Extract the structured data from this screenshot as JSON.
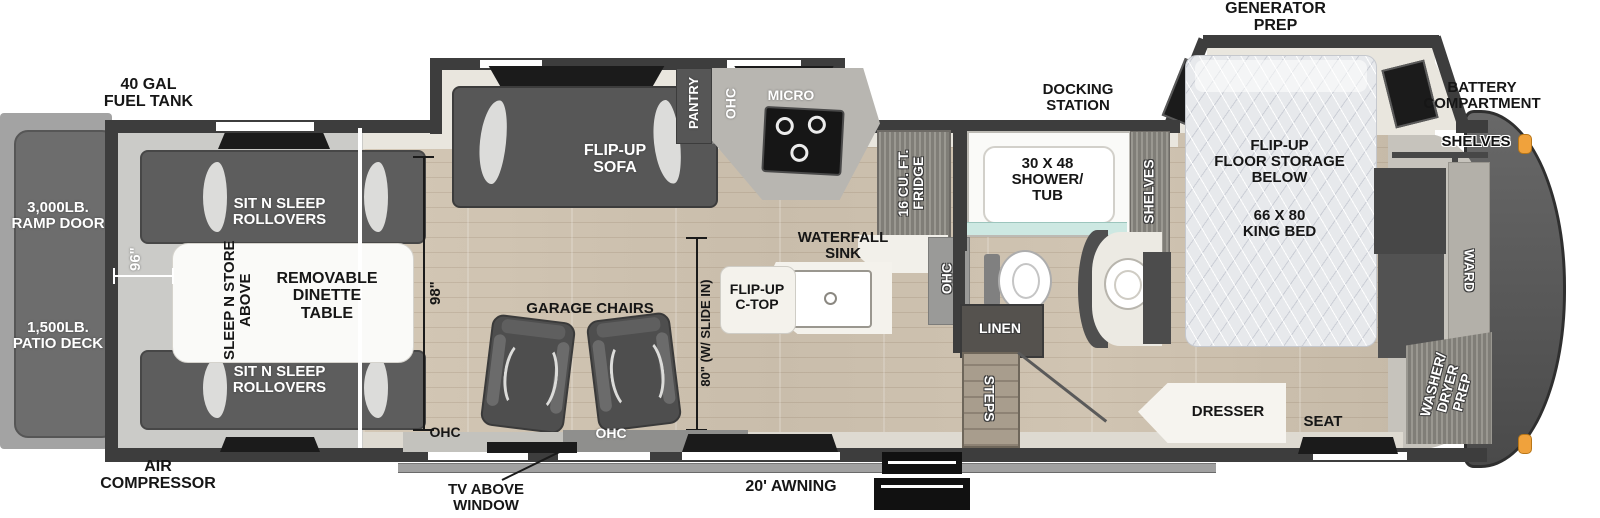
{
  "labels": {
    "fuel_tank": "40 GAL\nFUEL TANK",
    "generator_prep": "GENERATOR\nPREP",
    "docking_station": "DOCKING\nSTATION",
    "battery_compartment": "BATTERY\nCOMPARTMENT",
    "ramp_door": "3,000LB.\nRAMP DOOR",
    "patio_deck": "1,500LB.\nPATIO DECK",
    "air_compressor": "AIR\nCOMPRESSOR",
    "tv_above_window": "TV ABOVE\nWINDOW",
    "awning": "20' AWNING",
    "sit_n_sleep": "SIT N SLEEP\nROLLOVERS",
    "sleep_n_store": "SLEEP N STORE\nABOVE",
    "removable_dinette": "REMOVABLE\nDINETTE\nTABLE",
    "dim_96": "96\"",
    "dim_98": "98\"",
    "dim_80": "80\" (W/ SLIDE IN)",
    "garage_chairs": "GARAGE CHAIRS",
    "ohc": "OHC",
    "flip_up_sofa": "FLIP-UP\nSOFA",
    "pantry": "PANTRY",
    "micro": "MICRO",
    "fridge": "16 CU. FT.\nFRIDGE",
    "waterfall_sink": "WATERFALL\nSINK",
    "flip_up_ctop": "FLIP-UP\nC-TOP",
    "shower_tub": "30 X 48\nSHOWER/\nTUB",
    "shelves": "SHELVES",
    "linen": "LINEN",
    "steps": "STEPS",
    "flip_up_floor_storage": "FLIP-UP\nFLOOR STORAGE\nBELOW",
    "king_bed": "66 X 80\nKING BED",
    "ward": "WARD",
    "washer_dryer_prep": "WASHER/\nDRYER\nPREP",
    "dresser": "DRESSER",
    "seat": "SEAT"
  },
  "colors": {
    "wall": "#3d3d3d",
    "wood": "#cec2b0",
    "garage_floor": "#cbcbc8",
    "furniture_dark": "#555553",
    "counter_white": "#f4f2ec",
    "shower_glass": "#cde8e2",
    "marker_light": "#f0a23c",
    "mattress": "#e7e9ec"
  }
}
